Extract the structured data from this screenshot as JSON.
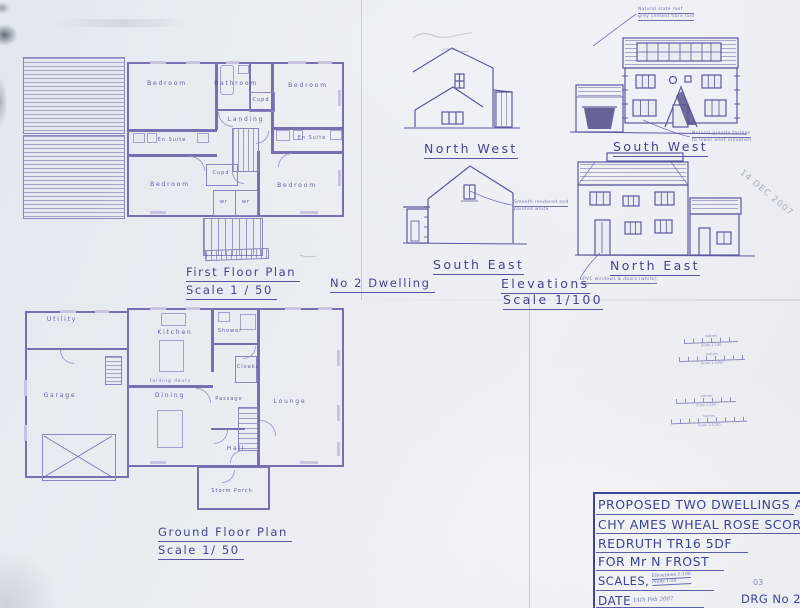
{
  "palette": {
    "paper": "#e8ecf1",
    "ink": "#55549c",
    "ink_dark": "#3b4397"
  },
  "first_floor_plan": {
    "title": "First Floor Plan",
    "scale": "Scale 1 / 50",
    "rooms": {
      "bedroom_nw": "Bedroom",
      "bathroom": "Bathroom",
      "bedroom_ne": "Bedroom",
      "cupd_top": "Cupd",
      "en_suite_w": "En Suite",
      "landing": "Landing",
      "en_suite_e": "En Suite",
      "bedroom_sw": "Bedroom",
      "cupd_mid": "Cupd",
      "wr_left": "wr",
      "wr_right": "wr",
      "bedroom_se": "Bedroom"
    }
  },
  "dwelling_note": "No 2 Dwelling",
  "elevations": {
    "title": "Elevations",
    "scale": "Scale 1/100",
    "labels": {
      "north_west": "North West",
      "south_west": "South West",
      "south_east": "South East",
      "north_east": "North East"
    },
    "notes": {
      "roof_line1": "Natural slate roof",
      "roof_line2": "grey cement fibre laid",
      "granite_line1": "Natural granite facings",
      "granite_line2": "to lower west elevation",
      "render_line1": "Smooth rendered and",
      "render_line2": "painted white",
      "upvc": "uPVC windows & doors (white)"
    }
  },
  "ground_floor_plan": {
    "title": "Ground Floor Plan",
    "scale": "Scale 1/ 50",
    "rooms": {
      "utility": "Utility",
      "kitchen": "Kitchen",
      "shower": "Shower",
      "cloaks": "Cloaks",
      "garage": "Garage",
      "dining": "Dining",
      "passage": "Passage",
      "lounge": "Lounge",
      "hall": "Hall",
      "storm_porch": "Storm Porch"
    },
    "notes": {
      "folding": "folding doors"
    }
  },
  "scale_bars": {
    "title": "metres",
    "items": [
      "Scale 1:100",
      "Scale 1:1250",
      "Scale 1:100",
      "Scale 1:1250"
    ]
  },
  "title_block": {
    "line1": "PROPOSED TWO DWELLINGS AT",
    "line2": "CHY AMES WHEAL ROSE SCORRIER",
    "line3": "REDRUTH TR16 5DF",
    "line4": "FOR Mr N FROST",
    "scales_label": "SCALES,",
    "scales_hand1": "Elevations 1:100",
    "scales_hand2": "Plans 1:50",
    "date_label": "DATE",
    "date_hand": "14th Feb 2007",
    "sheet_no": "03",
    "drg_no": "DRG No 20"
  },
  "stamp": "14 DEC 2007"
}
